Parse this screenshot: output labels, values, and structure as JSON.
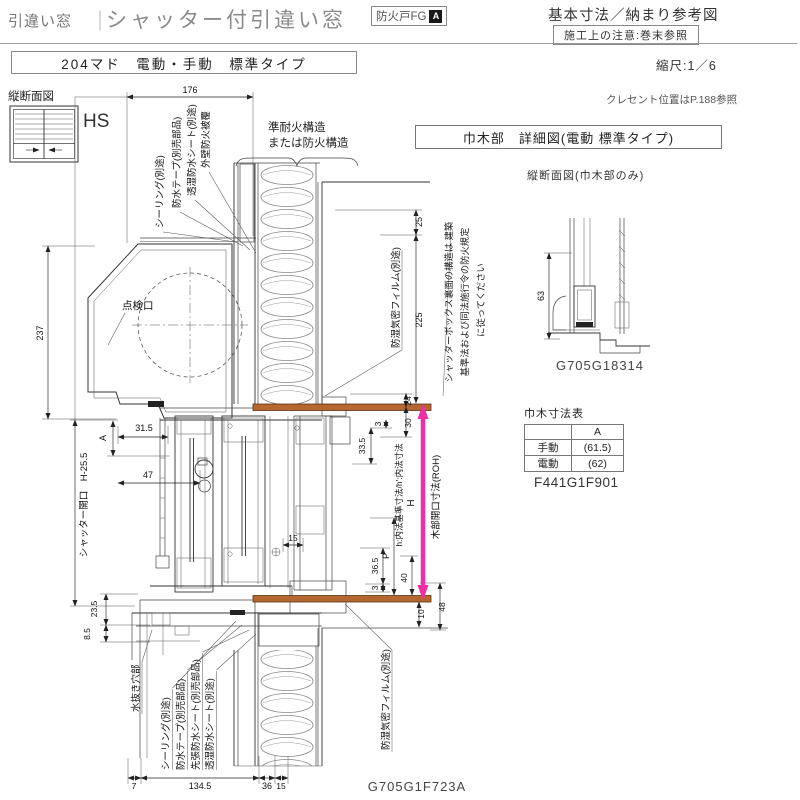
{
  "header": {
    "breadcrumb": "引違い窓",
    "divider": "｜",
    "title": "シャッター付引違い窓",
    "badge": "防火戸FG",
    "badge_mark": "A",
    "ref_title": "基本寸法／納まり参考図",
    "note_box": "施工上の注意:巻末参照"
  },
  "subheader": {
    "type_label": "204マド　電動・手動　標準タイプ",
    "scale": "縮尺:1／6"
  },
  "key": {
    "section": "縦断面図",
    "code": "HS"
  },
  "right_panel": {
    "crescent_note": "クレセント位置はP.188参照",
    "detail_title": "巾木部　詳細図(電動 標準タイプ)",
    "section_sub": "縦断面図(巾木部のみ)",
    "warn1": "シャッターボックス裏面の構造は 建築",
    "warn2": "基準法および同法施行令の防火規定",
    "warn3": "に従ってください",
    "detail_code": "G705G18314",
    "table_title": "巾木寸法表",
    "col_a": "A",
    "row1_label": "手動",
    "row1_value": "(61.5)",
    "row2_label": "電動",
    "row2_value": "(62)",
    "table_code": "F441G1F901"
  },
  "drawing": {
    "labels": {
      "wall1": "準耐火構造",
      "wall2": "または防火構造",
      "sealing": "シーリング(別途)",
      "tape": "防水テープ(別売部品)",
      "sheet": "透湿防水シート(別途)",
      "cover": "外壁防火被覆",
      "film": "防湿気密フィルム(別途)",
      "inspection": "点検口",
      "shutter_open": "シャッター開口　H-25.5",
      "drain": "水抜き穴部",
      "presheet": "先張防水シート(別売部品)",
      "h_note": "h:内法基準寸法/h':内法寸法",
      "roh": "木部開口寸法(ROH)",
      "h_mark": "H",
      "p_mark": "P",
      "a_mark": "A",
      "code": "G705G1F723A"
    },
    "dims": {
      "w176": "176",
      "h237": "237",
      "g25": "25",
      "g225": "225",
      "g24": "24",
      "g30": "30",
      "g3": "3",
      "g33_5": "33.5",
      "g31_5": "31.5",
      "g47": "47",
      "g15": "15",
      "g36_5": "36.5",
      "g40": "40",
      "g10": "10",
      "g48": "48",
      "g23_5": "23.5",
      "g8_5": "8.5",
      "g7": "7",
      "g134_5": "134.5",
      "g36": "36",
      "g63": "63"
    }
  },
  "colors": {
    "orange": "#b4672f",
    "magenta": "#ee2fa5",
    "line": "#333333"
  }
}
